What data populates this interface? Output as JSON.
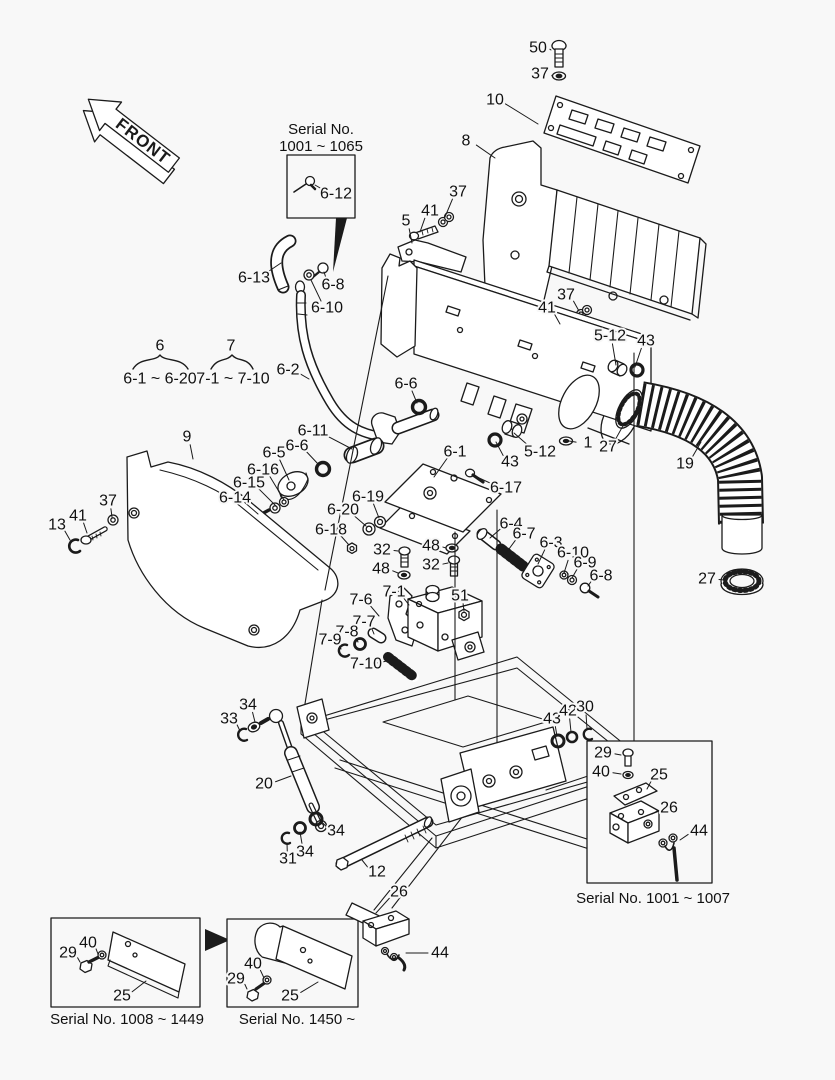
{
  "title": "Exploded parts diagram",
  "front_label": "FRONT",
  "colors": {
    "background": "#f8f8f8",
    "line": "#1b1b1b",
    "label": "#111111"
  },
  "groups": {
    "g6": {
      "num": "6",
      "range": "6-1 ~ 6-20"
    },
    "g7": {
      "num": "7",
      "range": "7-1 ~ 7-10"
    }
  },
  "serial_boxes": {
    "top": {
      "caption_line1": "Serial No.",
      "caption_line2": "1001 ~ 1065"
    },
    "right": {
      "caption": "Serial No. 1001 ~ 1007"
    },
    "bottom_left": {
      "caption": "Serial No. 1008 ~ 1449"
    },
    "bottom_center": {
      "caption": "Serial No. 1450 ~"
    }
  },
  "callouts": [
    {
      "t": "50",
      "x": 538,
      "y": 48,
      "lx": 551,
      "ly": 50
    },
    {
      "t": "37",
      "x": 540,
      "y": 74,
      "lx": 552,
      "ly": 76
    },
    {
      "t": "10",
      "x": 495,
      "y": 100,
      "lx": 538,
      "ly": 124
    },
    {
      "t": "8",
      "x": 466,
      "y": 141,
      "lx": 495,
      "ly": 158
    },
    {
      "t": "6-12",
      "x": 336,
      "y": 194,
      "lx": 315,
      "ly": 185
    },
    {
      "t": "5",
      "x": 406,
      "y": 221,
      "lx": 412,
      "ly": 243
    },
    {
      "t": "41",
      "x": 430,
      "y": 211,
      "lx": 420,
      "ly": 232
    },
    {
      "t": "37",
      "x": 458,
      "y": 192,
      "lx": 445,
      "ly": 217
    },
    {
      "t": "6-13",
      "x": 254,
      "y": 278,
      "lx": 281,
      "ly": 263
    },
    {
      "t": "6-8",
      "x": 333,
      "y": 285,
      "lx": 324,
      "ly": 272
    },
    {
      "t": "6-10",
      "x": 327,
      "y": 308,
      "lx": 311,
      "ly": 280
    },
    {
      "t": "41",
      "x": 547,
      "y": 308,
      "lx": 560,
      "ly": 324
    },
    {
      "t": "37",
      "x": 566,
      "y": 295,
      "lx": 579,
      "ly": 311
    },
    {
      "t": "5-12",
      "x": 610,
      "y": 336,
      "lx": 616,
      "ly": 365
    },
    {
      "t": "43",
      "x": 646,
      "y": 341,
      "lx": 635,
      "ly": 367
    },
    {
      "t": "6",
      "x": 160,
      "y": 346
    },
    {
      "t": "6-1 ~ 6-20",
      "x": 160,
      "y": 379
    },
    {
      "t": "7",
      "x": 231,
      "y": 346
    },
    {
      "t": "7-1 ~ 7-10",
      "x": 233,
      "y": 379
    },
    {
      "t": "6-2",
      "x": 288,
      "y": 370,
      "lx": 309,
      "ly": 379
    },
    {
      "t": "6-6",
      "x": 406,
      "y": 384,
      "lx": 417,
      "ly": 403
    },
    {
      "t": "9",
      "x": 187,
      "y": 437,
      "lx": 193,
      "ly": 459
    },
    {
      "t": "6-11",
      "x": 313,
      "y": 431,
      "lx": 352,
      "ly": 449
    },
    {
      "t": "6-6",
      "x": 297,
      "y": 446,
      "lx": 319,
      "ly": 465
    },
    {
      "t": "6-5",
      "x": 274,
      "y": 453,
      "lx": 289,
      "ly": 480
    },
    {
      "t": "6-16",
      "x": 263,
      "y": 470,
      "lx": 284,
      "ly": 500
    },
    {
      "t": "6-15",
      "x": 249,
      "y": 483,
      "lx": 276,
      "ly": 506
    },
    {
      "t": "6-14",
      "x": 235,
      "y": 498,
      "lx": 258,
      "ly": 514
    },
    {
      "t": "6-1",
      "x": 455,
      "y": 452,
      "lx": 434,
      "ly": 477
    },
    {
      "t": "43",
      "x": 510,
      "y": 462,
      "lx": 496,
      "ly": 442
    },
    {
      "t": "5-12",
      "x": 540,
      "y": 452,
      "lx": 514,
      "ly": 433
    },
    {
      "t": "1",
      "x": 588,
      "y": 443,
      "lx": 569,
      "ly": 441
    },
    {
      "t": "27",
      "x": 608,
      "y": 447,
      "lx": 624,
      "ly": 424
    },
    {
      "t": "19",
      "x": 685,
      "y": 464,
      "lx": 701,
      "ly": 442
    },
    {
      "t": "6-17",
      "x": 506,
      "y": 488,
      "lx": 477,
      "ly": 477
    },
    {
      "t": "13",
      "x": 57,
      "y": 525,
      "lx": 70,
      "ly": 540
    },
    {
      "t": "41",
      "x": 78,
      "y": 516,
      "lx": 87,
      "ly": 533
    },
    {
      "t": "37",
      "x": 108,
      "y": 501,
      "lx": 112,
      "ly": 517
    },
    {
      "t": "6-19",
      "x": 368,
      "y": 497,
      "lx": 379,
      "ly": 518
    },
    {
      "t": "6-20",
      "x": 343,
      "y": 510,
      "lx": 366,
      "ly": 526
    },
    {
      "t": "6-18",
      "x": 331,
      "y": 530,
      "lx": 349,
      "ly": 545
    },
    {
      "t": "32",
      "x": 382,
      "y": 550,
      "lx": 398,
      "ly": 551
    },
    {
      "t": "48",
      "x": 431,
      "y": 546,
      "lx": 446,
      "ly": 548
    },
    {
      "t": "48",
      "x": 381,
      "y": 569,
      "lx": 398,
      "ly": 573
    },
    {
      "t": "32",
      "x": 431,
      "y": 565,
      "lx": 448,
      "ly": 563
    },
    {
      "t": "6-4",
      "x": 511,
      "y": 524,
      "lx": 490,
      "ly": 538
    },
    {
      "t": "6-7",
      "x": 524,
      "y": 534,
      "lx": 506,
      "ly": 553
    },
    {
      "t": "6-3",
      "x": 551,
      "y": 543,
      "lx": 538,
      "ly": 564
    },
    {
      "t": "6-10",
      "x": 573,
      "y": 553,
      "lx": 564,
      "ly": 573
    },
    {
      "t": "6-9",
      "x": 585,
      "y": 563,
      "lx": 572,
      "ly": 578
    },
    {
      "t": "6-8",
      "x": 601,
      "y": 576,
      "lx": 588,
      "ly": 586
    },
    {
      "t": "51",
      "x": 460,
      "y": 596,
      "lx": 464,
      "ly": 611
    },
    {
      "t": "7-1",
      "x": 394,
      "y": 592,
      "lx": 409,
      "ly": 605
    },
    {
      "t": "7-6",
      "x": 361,
      "y": 600,
      "lx": 379,
      "ly": 616
    },
    {
      "t": "7-7",
      "x": 364,
      "y": 622,
      "lx": 374,
      "ly": 634
    },
    {
      "t": "7-8",
      "x": 347,
      "y": 632,
      "lx": 358,
      "ly": 642
    },
    {
      "t": "7-9",
      "x": 330,
      "y": 640,
      "lx": 341,
      "ly": 649
    },
    {
      "t": "7-10",
      "x": 366,
      "y": 664,
      "lx": 387,
      "ly": 661
    },
    {
      "t": "27",
      "x": 707,
      "y": 579,
      "lx": 724,
      "ly": 580
    },
    {
      "t": "34",
      "x": 248,
      "y": 705,
      "lx": 255,
      "ly": 722
    },
    {
      "t": "33",
      "x": 229,
      "y": 719,
      "lx": 240,
      "ly": 731
    },
    {
      "t": "20",
      "x": 264,
      "y": 784,
      "lx": 291,
      "ly": 776
    },
    {
      "t": "34",
      "x": 336,
      "y": 831,
      "lx": 320,
      "ly": 820
    },
    {
      "t": "34",
      "x": 305,
      "y": 852,
      "lx": 300,
      "ly": 832
    },
    {
      "t": "31",
      "x": 288,
      "y": 859,
      "lx": 287,
      "ly": 843
    },
    {
      "t": "12",
      "x": 377,
      "y": 872,
      "lx": 362,
      "ly": 860
    },
    {
      "t": "43",
      "x": 552,
      "y": 719,
      "lx": 557,
      "ly": 736
    },
    {
      "t": "42",
      "x": 568,
      "y": 711,
      "lx": 571,
      "ly": 732
    },
    {
      "t": "30",
      "x": 585,
      "y": 707,
      "lx": 587,
      "ly": 729
    },
    {
      "t": "29",
      "x": 603,
      "y": 753,
      "lx": 621,
      "ly": 755
    },
    {
      "t": "40",
      "x": 601,
      "y": 772,
      "lx": 621,
      "ly": 774
    },
    {
      "t": "25",
      "x": 659,
      "y": 775,
      "lx": 647,
      "ly": 789
    },
    {
      "t": "26",
      "x": 669,
      "y": 808,
      "lx": 652,
      "ly": 814
    },
    {
      "t": "44",
      "x": 699,
      "y": 831,
      "lx": 680,
      "ly": 840
    },
    {
      "t": "40",
      "x": 88,
      "y": 943,
      "lx": 98,
      "ly": 954
    },
    {
      "t": "29",
      "x": 68,
      "y": 953,
      "lx": 80,
      "ly": 962
    },
    {
      "t": "25",
      "x": 122,
      "y": 996,
      "lx": 146,
      "ly": 981
    },
    {
      "t": "40",
      "x": 253,
      "y": 964,
      "lx": 264,
      "ly": 978
    },
    {
      "t": "29",
      "x": 236,
      "y": 979,
      "lx": 247,
      "ly": 989
    },
    {
      "t": "25",
      "x": 290,
      "y": 996,
      "lx": 318,
      "ly": 982
    },
    {
      "t": "26",
      "x": 399,
      "y": 892,
      "lx": 376,
      "ly": 913
    },
    {
      "t": "44",
      "x": 440,
      "y": 953,
      "lx": 406,
      "ly": 953
    }
  ]
}
